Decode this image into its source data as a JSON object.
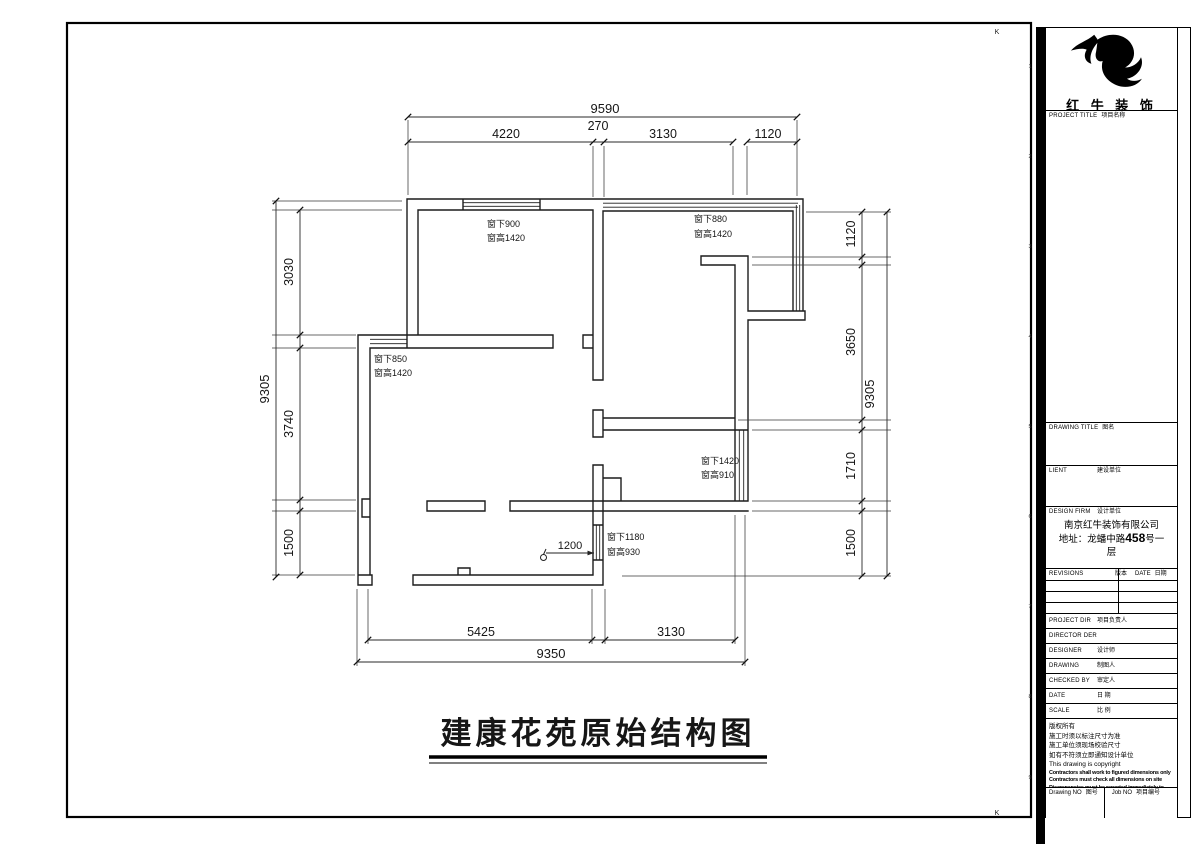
{
  "brand": {
    "name": "红 牛 装 饰"
  },
  "title_block": {
    "project_title": {
      "en": "PROJECT TITLE",
      "zh": "项目名称"
    },
    "drawing_title": {
      "en": "DRAWING TITLE",
      "zh": "图名"
    },
    "client": {
      "en": "LIENT",
      "zh": "建设单位"
    },
    "design_firm": {
      "en": "DESIGN FIRM",
      "zh": "设计单位"
    },
    "firm_name": "南京红牛装饰有限公司",
    "address_pre": "地址：龙蟠中路",
    "address_num": "458",
    "address_post": "号一",
    "address_tail": "层",
    "revisions": {
      "en": "REVISIONS",
      "zh": "版本"
    },
    "rev_date": {
      "en": "DATE",
      "zh": "日期"
    },
    "rows": [
      {
        "en": "PROJECT DIR",
        "zh": "项目负责人"
      },
      {
        "en": "DIRECTOR DER",
        "zh": ""
      },
      {
        "en": "DESIGNER",
        "zh": "设计师"
      },
      {
        "en": "DRAWING",
        "zh": "制图人"
      },
      {
        "en": "CHECKED BY",
        "zh": "审定人"
      },
      {
        "en": "DATE",
        "zh": "日 期"
      },
      {
        "en": "SCALE",
        "zh": "比 例"
      }
    ],
    "copyright": [
      "版权所有",
      "施工时须以标注尺寸为准",
      "施工单位须现场校验尺寸",
      "如有不符须立即通知设计单位",
      "This drawing is copyright"
    ],
    "copyright_bold": [
      "Contractors shall work to figured dimensions only",
      "Contractors must check all dimensions on site",
      "Discrepancies must be reported immediately to architects"
    ],
    "drawing_no": {
      "en": "Drawing NO",
      "zh": "图号"
    },
    "job_no": {
      "en": "Job NO",
      "zh": "项目编号"
    }
  },
  "plan": {
    "title": "建康花苑原始结构图",
    "dim_top": {
      "overall": "9590",
      "seg1": "4220",
      "seg2": "270",
      "seg3": "3130",
      "seg4": "1120"
    },
    "dim_left": {
      "overall": "9305",
      "seg1": "3030",
      "seg2": "3740",
      "seg3": "1500"
    },
    "dim_right": {
      "overall": "9305",
      "seg1": "1120",
      "seg2": "3650",
      "seg3": "1710",
      "seg4": "1500"
    },
    "dim_bottom": {
      "overall": "9350",
      "seg1": "5425",
      "seg2": "3130"
    },
    "windows": {
      "top_left": {
        "l1": "窗下900",
        "l2": "窗高1420"
      },
      "top_right": {
        "l1": "窗下880",
        "l2": "窗高1420"
      },
      "left": {
        "l1": "窗下850",
        "l2": "窗高1420"
      },
      "mid_right": {
        "l1": "窗下1420",
        "l2": "窗高910"
      },
      "bottom": {
        "l1": "窗下1180",
        "l2": "窗高930"
      }
    },
    "leader": "1200"
  },
  "frame": {
    "marker_top": "K",
    "marker_bottom": "K",
    "zones": [
      "1",
      "2",
      "3",
      "4",
      "5",
      "6",
      "7",
      "8",
      "9"
    ]
  }
}
